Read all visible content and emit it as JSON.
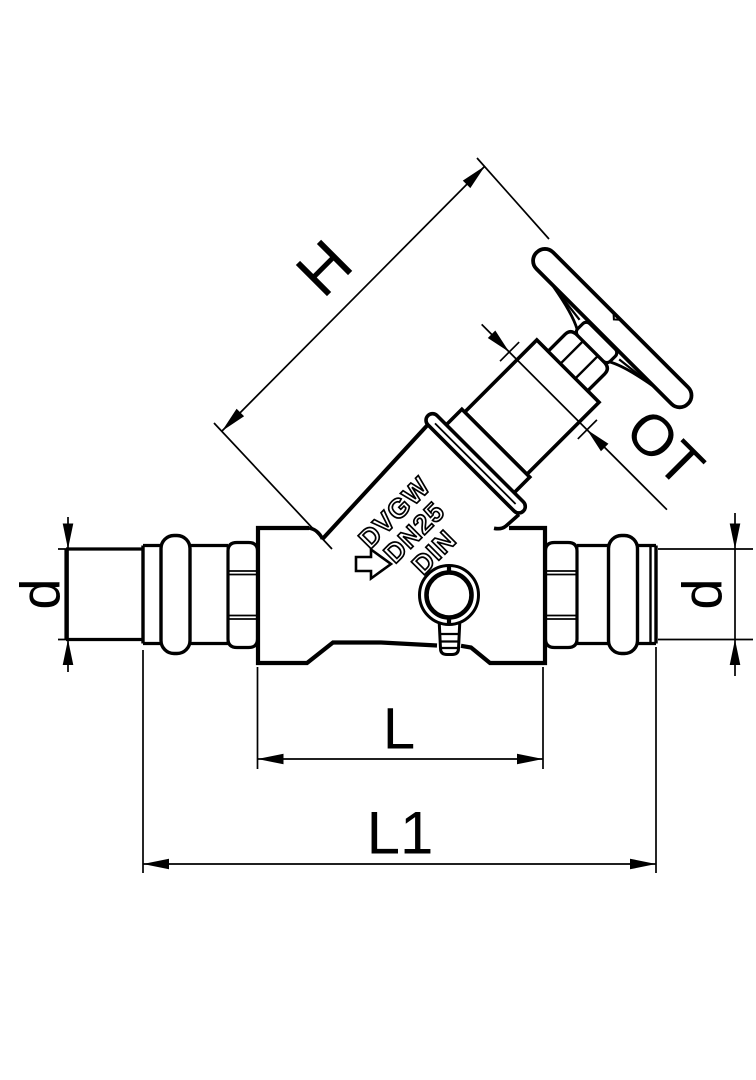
{
  "drawing": {
    "type": "technical-line-drawing",
    "subject": "slanted-seat stop valve with press connections, handwheel and drain boss",
    "background_color": "#ffffff",
    "line_color": "#000000",
    "dimension_labels": {
      "H": "H",
      "OT": "OT",
      "d_left": "d",
      "d_right": "d",
      "L": "L",
      "L1": "L1"
    },
    "cast_marking": {
      "line1": "DVGW",
      "line2": "DN25",
      "line3": "DIN"
    }
  }
}
